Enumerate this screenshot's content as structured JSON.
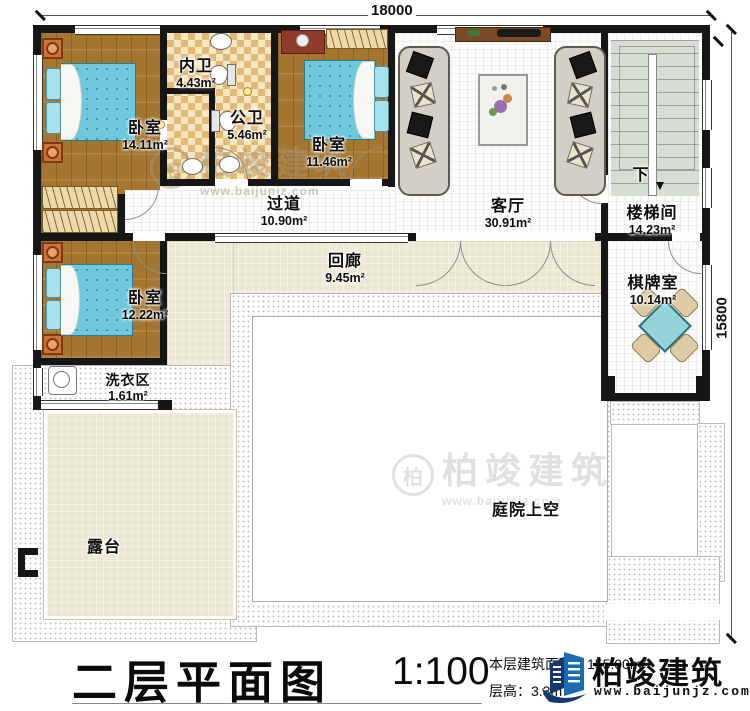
{
  "plan": {
    "dimensions": {
      "top": "18000",
      "right": "15800"
    },
    "rooms": [
      {
        "name": "卧室",
        "area": "14.11m²"
      },
      {
        "name": "内卫",
        "area": "4.43m²"
      },
      {
        "name": "公卫",
        "area": "5.46m²"
      },
      {
        "name": "卧室",
        "area": "11.46m²"
      },
      {
        "name": "客厅",
        "area": "30.91m²"
      },
      {
        "name": "楼梯间",
        "area": "14.23m²"
      },
      {
        "name": "过道",
        "area": "10.90m²"
      },
      {
        "name": "回廊",
        "area": "9.45m²"
      },
      {
        "name": "卧室",
        "area": "12.22m²"
      },
      {
        "name": "洗衣区",
        "area": "1.61m²"
      },
      {
        "name": "棋牌室",
        "area": "10.14m²"
      },
      {
        "name": "露台",
        "area": ""
      },
      {
        "name": "庭院上空",
        "area": ""
      }
    ],
    "stair_down_label": "下"
  },
  "titlebar": {
    "title": "二层平面图",
    "scale": "1:100",
    "floor_area_label": "本层建筑面积：",
    "floor_area_value": "155.00m²",
    "floor_height_label": "层高：",
    "floor_height_value": "3.3m",
    "brand_name": "柏竣建筑",
    "brand_site": "www.baijunjz.com"
  },
  "watermark": {
    "brand": "柏竣建筑",
    "site": "www.baijunjz.com"
  },
  "colors": {
    "wall": "#161616",
    "wood_floor": "#a5762f",
    "bath_tile": "#e2b877",
    "veranda_cream": "#ece7d2",
    "stair_green": "#d6ddd2",
    "bed_blue": "#6fc7dc",
    "nightstand_orange": "#d0713a",
    "chess_table_teal": "#93d3d9",
    "brand_blue": "#1b6cb5",
    "brand_navy": "#14386e"
  }
}
